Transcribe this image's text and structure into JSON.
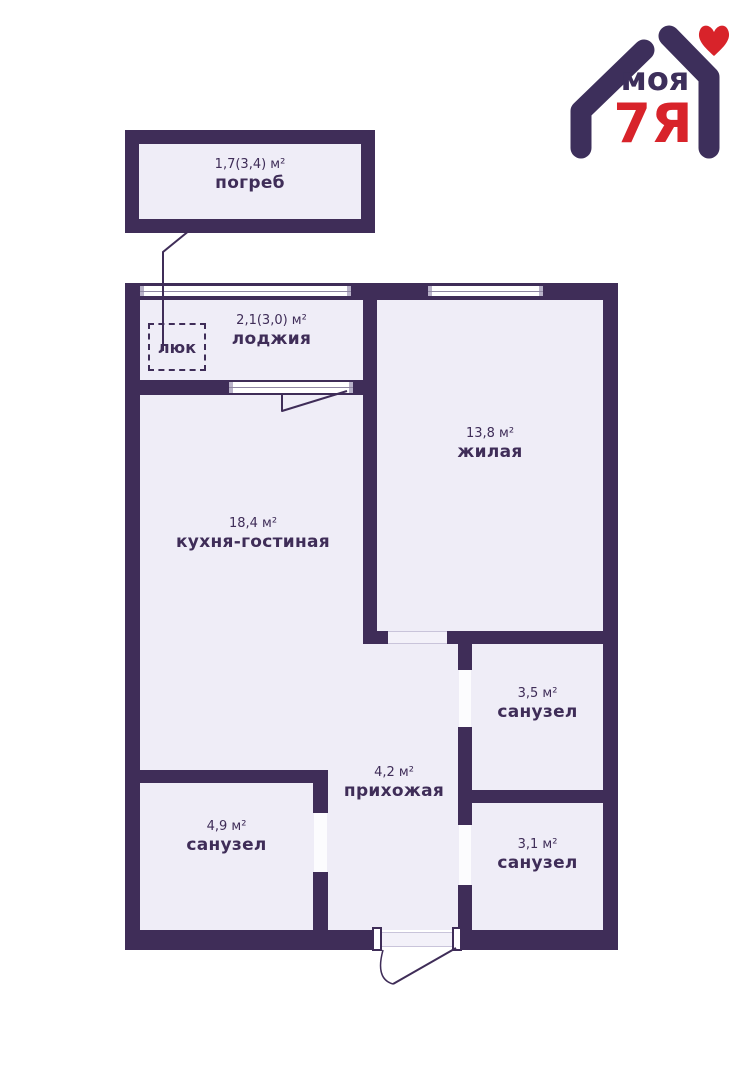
{
  "colors": {
    "wall": "#3F2D58",
    "floor": "#EFEDF7",
    "text": "#3F2D58",
    "logo_purple": "#3D2F5B",
    "logo_red": "#D8232A"
  },
  "logo": {
    "word": "моя",
    "family": "7Я"
  },
  "hatch_label": "люк",
  "rooms": [
    {
      "area": "1,7(3,4) м²",
      "name": "погреб"
    },
    {
      "area": "2,1(3,0) м²",
      "name": "лоджия"
    },
    {
      "area": "13,8 м²",
      "name": "жилая"
    },
    {
      "area": "18,4 м²",
      "name": "кухня-гостиная"
    },
    {
      "area": "3,5 м²",
      "name": "санузел"
    },
    {
      "area": "4,2 м²",
      "name": "прихожая"
    },
    {
      "area": "4,9 м²",
      "name": "санузел"
    },
    {
      "area": "3,1 м²",
      "name": "санузел"
    }
  ]
}
